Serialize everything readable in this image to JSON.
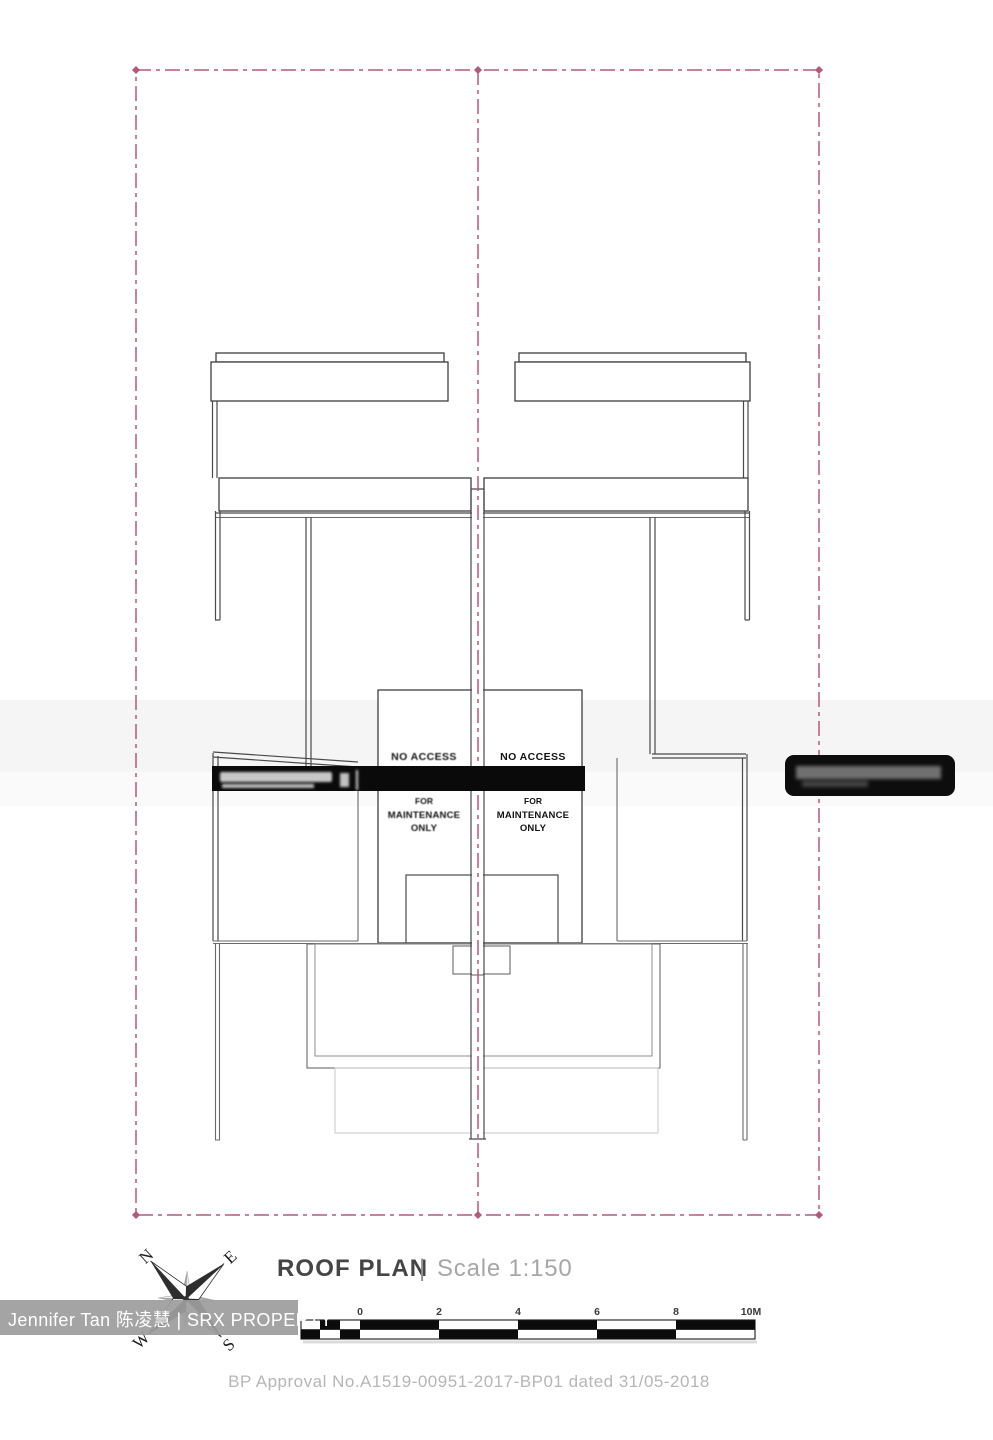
{
  "header": {
    "title": "ROOF PLAN",
    "separator": "|",
    "scale": "Scale 1:150"
  },
  "plan": {
    "left_unit_note": {
      "line1": "NO ACCESS",
      "line2": "FOR",
      "line3": "MAINTENANCE",
      "line4": "ONLY"
    },
    "right_unit_note": {
      "line1": "NO ACCESS",
      "line2": "FOR",
      "line3": "MAINTENANCE",
      "line4": "ONLY"
    }
  },
  "compass": {
    "north": "N",
    "east": "E",
    "south": "S",
    "west": "W"
  },
  "scale_bar": {
    "labels": [
      "0",
      "2",
      "4",
      "6",
      "8",
      "10M"
    ]
  },
  "watermark": {
    "text": "Jennifer Tan 陈凌慧 | SRX PROPERTY"
  },
  "approval": {
    "text": "BP Approval No.A1519-00951-2017-BP01 dated 31/05-2018"
  },
  "colors": {
    "boundary_pink": "#b5587a",
    "line_dark": "#4a4a4a",
    "redaction_black": "#0a0a0a",
    "watermark_band": "#9d9d9d",
    "title_dark": "#454545",
    "title_gray": "#a7a7a7"
  }
}
